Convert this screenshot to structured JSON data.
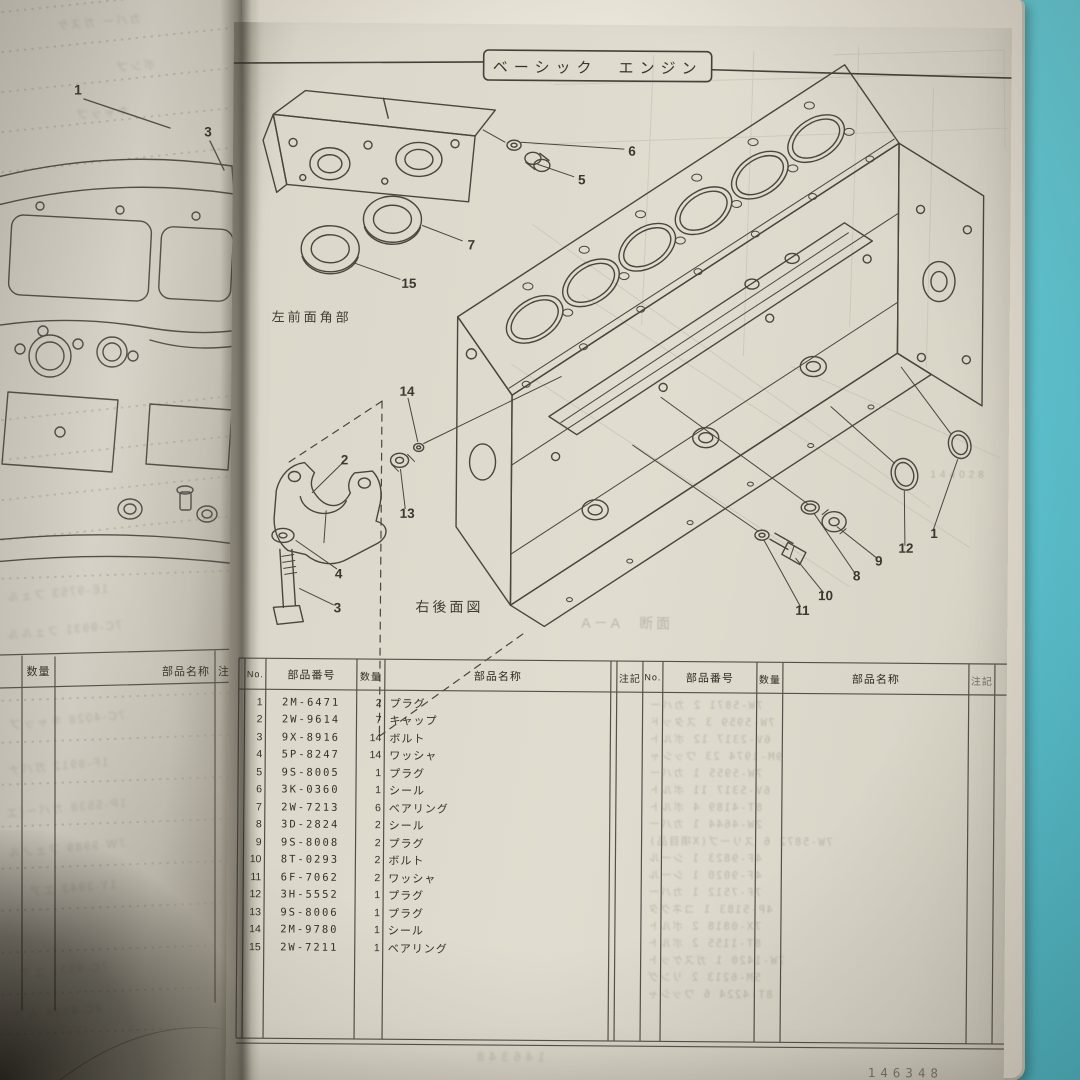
{
  "page": {
    "title": "ベーシック　エンジン",
    "footer_number": "146348",
    "ghost_number": "144028"
  },
  "labels": {
    "front_left_corner": "左前面角部",
    "rear_right_view": "右後面図",
    "section_ghost": "A－A　断面"
  },
  "left_page": {
    "callouts": [
      {
        "n": "1",
        "x": 78,
        "y": 90
      },
      {
        "n": "3",
        "x": 208,
        "y": 132
      }
    ],
    "table_header": {
      "qty": "数量",
      "name": "部品名称",
      "note": "注記"
    },
    "ghost_lines": [
      {
        "t": "カバー ガスケ",
        "x": 55,
        "y": 14
      },
      {
        "t": "ポンプ",
        "x": 115,
        "y": 58
      },
      {
        "t": "キャップ",
        "x": 75,
        "y": 105
      },
      {
        "t": "1E-9753 フェル",
        "x": 5,
        "y": 585
      },
      {
        "t": "7C-9931 フェルル",
        "x": 5,
        "y": 622
      },
      {
        "t": "7C-4028 キャップ",
        "x": 8,
        "y": 712
      },
      {
        "t": "1F-9912 ガバナ",
        "x": 6,
        "y": 758
      },
      {
        "t": "1P-5538 カバー(エ",
        "x": 4,
        "y": 800
      },
      {
        "t": "7W-9989 フェノル",
        "x": 6,
        "y": 840
      },
      {
        "t": "1Y-3943 エア",
        "x": 28,
        "y": 880
      },
      {
        "t": "7C-9931 エア",
        "x": 18,
        "y": 962
      },
      {
        "t": "4C-9528 ムア",
        "x": 12,
        "y": 1004
      }
    ]
  },
  "diagram": {
    "callouts": [
      {
        "n": "6",
        "x": 399,
        "y": 126
      },
      {
        "n": "5",
        "x": 349,
        "y": 155
      },
      {
        "n": "7",
        "x": 239,
        "y": 221
      },
      {
        "n": "15",
        "x": 177,
        "y": 260
      },
      {
        "n": "14",
        "x": 176,
        "y": 368
      },
      {
        "n": "2",
        "x": 114,
        "y": 437
      },
      {
        "n": "13",
        "x": 177,
        "y": 490
      },
      {
        "n": "4",
        "x": 109,
        "y": 551
      },
      {
        "n": "3",
        "x": 108,
        "y": 585
      },
      {
        "n": "11",
        "x": 573,
        "y": 584
      },
      {
        "n": "10",
        "x": 596,
        "y": 569
      },
      {
        "n": "8",
        "x": 627,
        "y": 549
      },
      {
        "n": "9",
        "x": 649,
        "y": 534
      },
      {
        "n": "12",
        "x": 676,
        "y": 521
      },
      {
        "n": "1",
        "x": 704,
        "y": 506
      }
    ]
  },
  "table": {
    "headers": {
      "no": "No.",
      "part_number": "部品番号",
      "qty": "数量",
      "name": "部品名称",
      "note": "注記"
    },
    "rows": [
      {
        "no": "1",
        "part": "2M-6471",
        "qty": "2",
        "name": "プラグ"
      },
      {
        "no": "2",
        "part": "2W-9614",
        "qty": "7",
        "name": "キャップ"
      },
      {
        "no": "3",
        "part": "9X-8916",
        "qty": "14",
        "name": "ボルト"
      },
      {
        "no": "4",
        "part": "5P-8247",
        "qty": "14",
        "name": "ワッシャ"
      },
      {
        "no": "5",
        "part": "9S-8005",
        "qty": "1",
        "name": "プラグ"
      },
      {
        "no": "6",
        "part": "3K-0360",
        "qty": "1",
        "name": "シール"
      },
      {
        "no": "7",
        "part": "2W-7213",
        "qty": "6",
        "name": "ベアリング"
      },
      {
        "no": "8",
        "part": "3D-2824",
        "qty": "2",
        "name": "シール"
      },
      {
        "no": "9",
        "part": "9S-8008",
        "qty": "2",
        "name": "プラグ"
      },
      {
        "no": "10",
        "part": "8T-0293",
        "qty": "2",
        "name": "ボルト"
      },
      {
        "no": "11",
        "part": "6F-7062",
        "qty": "2",
        "name": "ワッシャ"
      },
      {
        "no": "12",
        "part": "3H-5552",
        "qty": "1",
        "name": "プラグ"
      },
      {
        "no": "13",
        "part": "9S-8006",
        "qty": "1",
        "name": "プラグ"
      },
      {
        "no": "14",
        "part": "2M-9780",
        "qty": "1",
        "name": "シール"
      },
      {
        "no": "15",
        "part": "2W-7211",
        "qty": "1",
        "name": "ベアリング"
      }
    ],
    "right_ghost_rows": [
      "7W-5871 2 カバー",
      "7W-5959 3 スタッド",
      "6V-2317 12 ボルト",
      "9M-1974 23 ワッシャ",
      "7W-5955 1 カバー",
      "6V-5317 11 ボルト",
      "8T-4189 4 ボルト",
      "2W-4644 1 カバー",
      "7W-5872 6 スリーブ(X項目品)",
      "4F-9823 1 シール",
      "4F-9020 1 シール",
      "7F-7512 1 カバー",
      "4P-5183 1 コネクタ",
      "7X-0818 2 ボルト",
      "8T-1155 2 ボルト",
      "7W-1420 1 ガスケット",
      "5M-6213 2 リング",
      "8T-4224 6 ワッシャ"
    ]
  }
}
